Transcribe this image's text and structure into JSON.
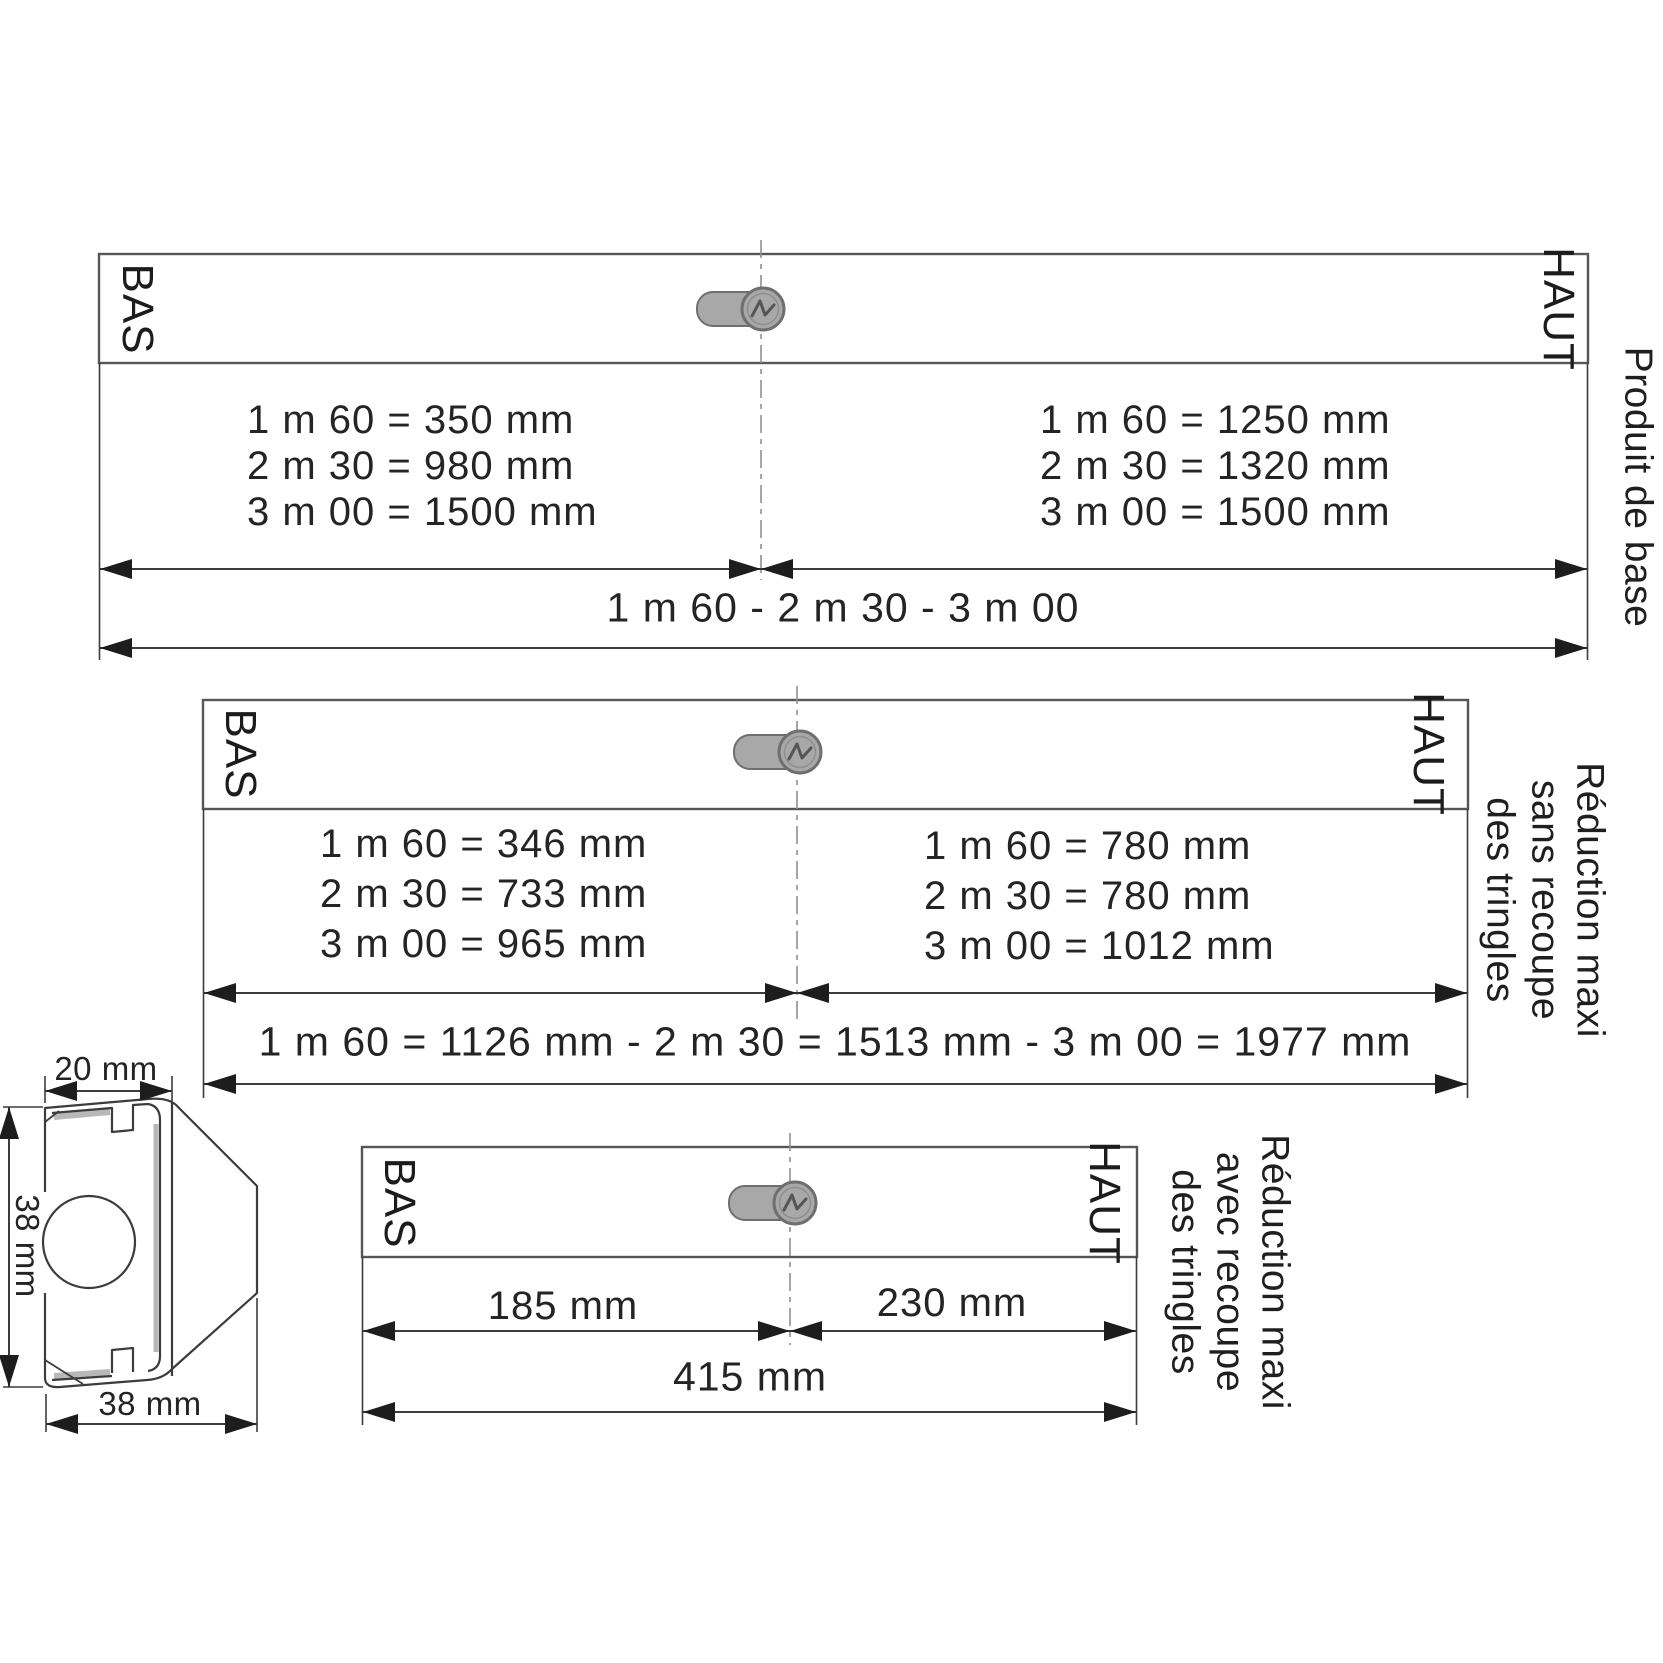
{
  "colors": {
    "line": "#3c3c3c",
    "bar_border": "#565656",
    "centerline": "#909090",
    "arrow": "#1d1d1d",
    "icon_fill": "#a8a8a8",
    "icon_stroke": "#6f6f6f",
    "profile_gray": "#b8b8b8"
  },
  "diagrams": [
    {
      "bas": "BAS",
      "haut": "HAUT",
      "left_values": [
        "1 m 60 = 350 mm",
        "2 m 30 = 980 mm",
        "3 m 00 = 1500 mm"
      ],
      "right_values": [
        "1 m 60 = 1250 mm",
        "2 m 30 = 1320 mm",
        "3 m 00 = 1500 mm"
      ],
      "total": "1 m 60 - 2 m 30 - 3 m 00",
      "caption_lines": [
        "Produit de base"
      ]
    },
    {
      "bas": "BAS",
      "haut": "HAUT",
      "left_values": [
        "1 m 60 = 346 mm",
        "2 m 30 = 733 mm",
        "3 m 00 = 965 mm"
      ],
      "right_values": [
        "1 m 60 = 780 mm",
        "2 m 30 = 780 mm",
        "3 m 00 = 1012 mm"
      ],
      "total": "1 m 60 = 1126 mm - 2 m 30 = 1513 mm - 3 m 00 = 1977 mm",
      "caption_lines": [
        "Réduction maxi",
        "sans recoupe",
        "des tringles"
      ]
    },
    {
      "bas": "BAS",
      "haut": "HAUT",
      "left_values": [
        "185 mm"
      ],
      "right_values": [
        "230 mm"
      ],
      "total": "415 mm",
      "caption_lines": [
        "Réduction maxi",
        "avec recoupe",
        "des tringles"
      ]
    }
  ],
  "cross_section": {
    "top_dim": "20 mm",
    "left_dim": "38 mm",
    "bottom_dim": "38 mm"
  }
}
